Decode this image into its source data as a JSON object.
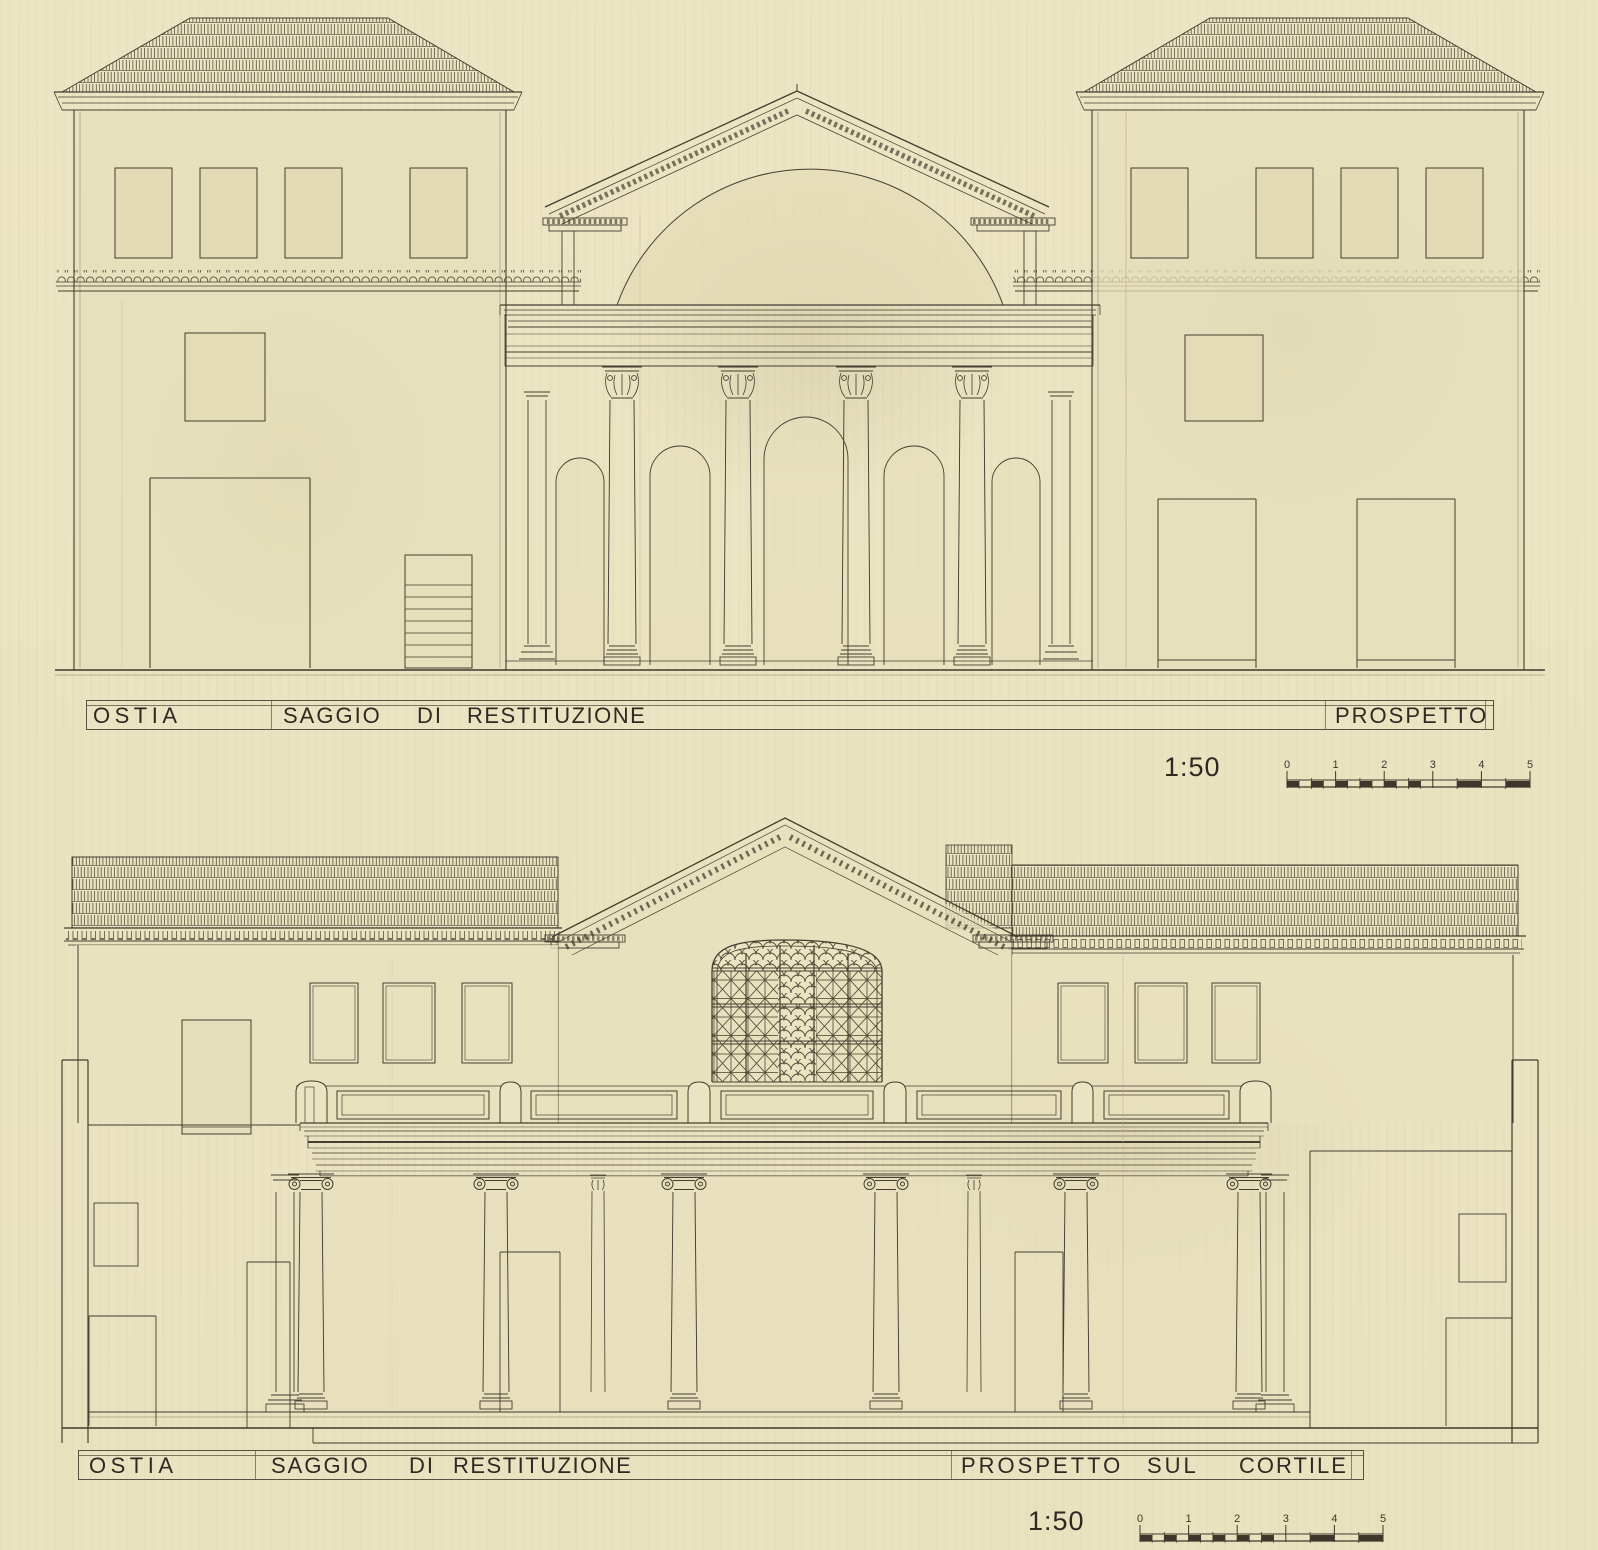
{
  "sheet": {
    "paper_color": "#ebe4c2",
    "ink_color": "#3e382c",
    "wash_color": "#e6dfbb"
  },
  "top_drawing": {
    "title": {
      "site": "OSTIA",
      "study_1": "SAGGIO",
      "study_2": "DI",
      "study_3": "RESTITUZIONE",
      "view": "PROSPETTO"
    },
    "scale": {
      "ratio": "1:50",
      "ticks": [
        "0",
        "1",
        "2",
        "3",
        "4",
        "5"
      ]
    }
  },
  "bottom_drawing": {
    "title": {
      "site": "OSTIA",
      "study_1": "SAGGIO",
      "study_2": "DI",
      "study_3": "RESTITUZIONE",
      "view_1": "PROSPETTO",
      "view_2": "SUL",
      "view_3": "CORTILE"
    },
    "scale": {
      "ratio": "1:50",
      "ticks": [
        "0",
        "1",
        "2",
        "3",
        "4",
        "5"
      ]
    }
  }
}
